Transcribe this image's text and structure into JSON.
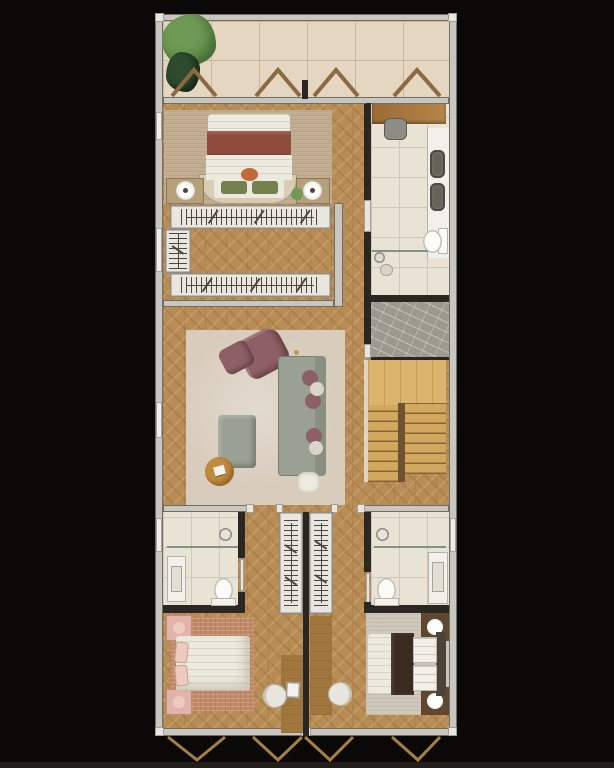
{
  "scene": {
    "type": "residential-floor-plan-top-view",
    "orientation": "vertical-unit-with-balcony-top",
    "rooms": [
      {
        "name": "balcony-terrace",
        "floor": "travertine-tile",
        "features": [
          "corner-tree-plant",
          "potted-plant",
          "four-window-swing-marks"
        ]
      },
      {
        "name": "master-bedroom",
        "floor": "herringbone-wood",
        "features": [
          "double-bed",
          "maroon-bed-runner",
          "curved-headboard-bench",
          "two-green-cushions",
          "nightstand-left-with-lamp",
          "nightstand-right-with-lamp",
          "beige-area-rug",
          "small-plant"
        ]
      },
      {
        "name": "walk-in-closet",
        "features": [
          "wardrobe-rail-top",
          "wardrobe-rail-bottom",
          "wardrobe-rail-side",
          "window-left"
        ]
      },
      {
        "name": "bathroom-suite-top-right",
        "floor": "marble-tile",
        "features": [
          "wood-bench",
          "stool",
          "double-sink-vanity",
          "toilet",
          "glass-partition",
          "shower-area"
        ]
      },
      {
        "name": "elevator-shaft",
        "floor": "gray-marble"
      },
      {
        "name": "staircase",
        "features": [
          "upper-landing",
          "left-flight",
          "right-flight",
          "center-divider"
        ]
      },
      {
        "name": "living-room",
        "floor": "herringbone-wood",
        "features": [
          "large-beige-rug",
          "gray-sofa",
          "mauve-throw-pillows",
          "mauve-armchair",
          "mauve-ottoman",
          "gray-coffee-table",
          "round-wood-side-table",
          "white-pouf"
        ]
      },
      {
        "name": "hallway-left",
        "floor": "herringbone-wood"
      },
      {
        "name": "hallway-right",
        "floor": "herringbone-wood"
      },
      {
        "name": "bathroom-bottom-left",
        "floor": "marble-tile",
        "features": [
          "shower",
          "glass-partition",
          "vanity",
          "toilet",
          "window-left"
        ]
      },
      {
        "name": "bathroom-bottom-right",
        "floor": "marble-tile",
        "features": [
          "shower",
          "glass-partition",
          "vanity",
          "toilet",
          "window-right"
        ]
      },
      {
        "name": "wardrobe-column-left",
        "features": [
          "hanging-rail"
        ]
      },
      {
        "name": "wardrobe-column-right",
        "features": [
          "hanging-rail"
        ]
      },
      {
        "name": "bedroom-bottom-left",
        "floor": "herringbone-wood",
        "features": [
          "double-bed-pink",
          "pink-nightstands",
          "terracotta-rug",
          "built-in-desk",
          "desk-chair",
          "laptop"
        ]
      },
      {
        "name": "bedroom-bottom-right",
        "floor": "herringbone-wood",
        "features": [
          "double-bed-brown-runner",
          "dark-nightstands-with-lamps",
          "greige-rug",
          "built-in-desk",
          "desk-chair"
        ]
      }
    ],
    "window_marks": {
      "top_chevrons_up": 4,
      "bottom_chevrons_down": 4
    }
  },
  "palette": {
    "bg": "#0b0908",
    "bg_strip": "#231e19",
    "wall": "#c9c5bf",
    "wall_hi": "#efede8",
    "wall_dark": "#2a2622",
    "jamb": "#e9e6e0",
    "frame_line": "#8f8c86",
    "wood": "#b88c55",
    "travertine": "#e4d6c0",
    "trav_line": "#c6b69c",
    "marble": "#e9e3d6",
    "marble_line": "#cfc8b9",
    "marble_dark": "#9c998e",
    "stair": "#d2a85f",
    "stair_land": "#dcb46e",
    "stair_div": "#6f5230",
    "rug_master": "#c2ae93",
    "rug_living": "#d8ccbc",
    "rug_pink": "#c08a68",
    "rug_gray": "#cec8bb",
    "white_soft": "#eceade",
    "cream": "#d8cdb2",
    "maroon": "#8e4b3b",
    "green_pillow": "#74814f",
    "orange": "#c06a38",
    "tan": "#b5a07a",
    "tick": "#4c4840",
    "sofa": "#9aa093",
    "sofa_dark": "#899082",
    "mauve": "#8d6066",
    "pouf": "#edebdf",
    "table_gray": "#99a094",
    "table_wood": "#c08b3f",
    "bench": "#9b6c35",
    "stool": "#8f8c85",
    "fixture": "#f2f0ea",
    "sink": "#666259",
    "glass": "#7e9488",
    "pink": "#e2b3a9",
    "pink_light": "#efcabf",
    "brown_dark": "#3c2b21",
    "ns_brown": "#5f4730",
    "head_gray": "#4a443c",
    "desk": "#a0763f",
    "chair": "#e8e5dd",
    "tree": "#6f9a55",
    "tree_dark": "#2e4b2e",
    "chevron": "#8a6a3e",
    "gold": "#a5803f"
  }
}
